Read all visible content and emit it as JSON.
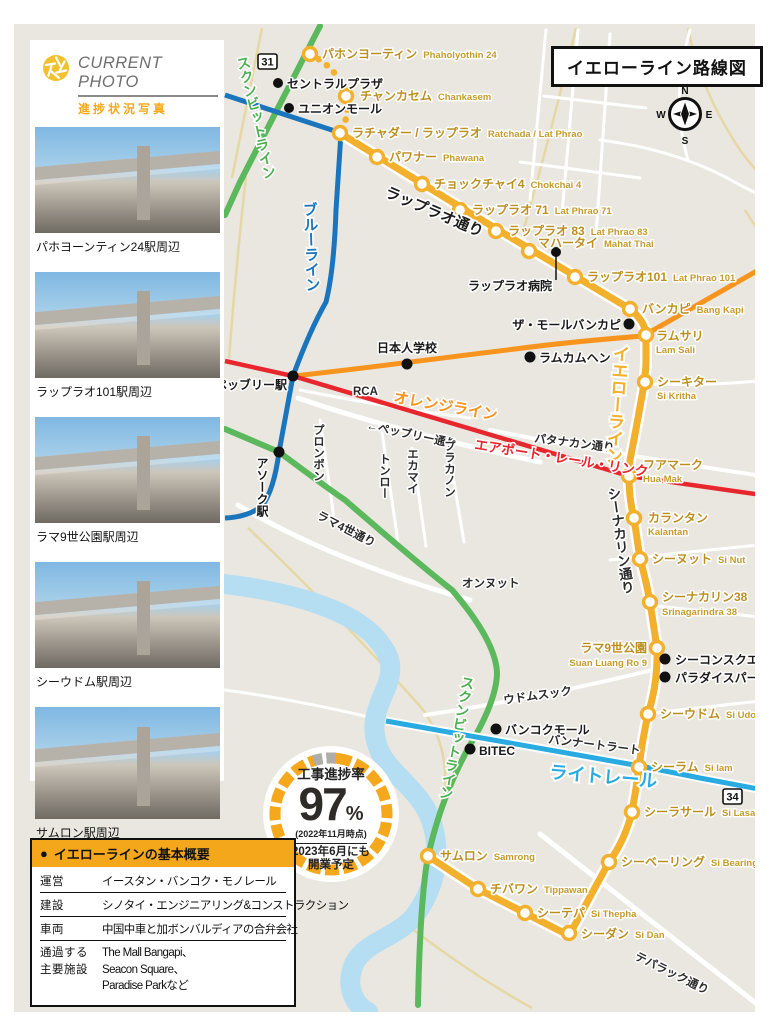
{
  "page": {
    "title_box": "イエローライン路線図"
  },
  "colors": {
    "yellow_line": "#F3B02C",
    "green_line": "#5CB85C",
    "blue_line": "#1B75BC",
    "orange_line": "#F7941E",
    "red_line": "#E8262D",
    "light_rail": "#29ABE2",
    "river": "#B5DEF2",
    "map_bg": "#EAE7E1",
    "accent_orange": "#F5A71B",
    "station_text": "#BC8F1E"
  },
  "compass": {
    "n": "N",
    "e": "E",
    "s": "S",
    "w": "W"
  },
  "shields": {
    "r31": "31",
    "r34": "34"
  },
  "lines": {
    "yellow": "イエローライン",
    "green": "スクンビットライン",
    "blue": "ブルーライン",
    "orange": "オレンジライン",
    "red": "エアポート・レール・リンク",
    "lightblue": "ライトレール"
  },
  "stations": [
    {
      "jp": "パホンヨーティン",
      "en": "Phaholyothin 24"
    },
    {
      "jp": "チャンカセム",
      "en": "Chankasem"
    },
    {
      "jp": "ラチャダー / ラップラオ",
      "en": "Ratchada / Lat Phrao"
    },
    {
      "jp": "パワナー",
      "en": "Phawana"
    },
    {
      "jp": "チョックチャイ4",
      "en": "Chokchai 4"
    },
    {
      "jp": "ラップラオ 71",
      "en": "Lat Phrao 71"
    },
    {
      "jp": "ラップラオ 83",
      "en": "Lat Phrao 83"
    },
    {
      "jp": "マハータイ",
      "en": "Mahat Thai"
    },
    {
      "jp": "ラップラオ101",
      "en": "Lat Phrao 101"
    },
    {
      "jp": "バンカピ",
      "en": "Bang Kapi"
    },
    {
      "jp": "ラムサリ",
      "en": "Lam Sali"
    },
    {
      "jp": "シーキター",
      "en": "Si Kritha"
    },
    {
      "jp": "フアマーク",
      "en": "Hua Mak"
    },
    {
      "jp": "カランタン",
      "en": "Kalantan"
    },
    {
      "jp": "シーヌット",
      "en": "Si Nut"
    },
    {
      "jp": "シーナカリン38",
      "en": "Srinagarindra 38"
    },
    {
      "jp": "ラマ9世公園",
      "en": "Suan Luang Ro 9"
    },
    {
      "jp": "シーウドム",
      "en": "Si Udom"
    },
    {
      "jp": "シーラム",
      "en": "Si Iam"
    },
    {
      "jp": "シーラサール",
      "en": "Si Lasalle"
    },
    {
      "jp": "シーベーリング",
      "en": "Si Bearing"
    },
    {
      "jp": "シーダン",
      "en": "Si Dan"
    },
    {
      "jp": "シーテパ",
      "en": "Si Thepha"
    },
    {
      "jp": "チバワン",
      "en": "Tippawan"
    },
    {
      "jp": "サムロン",
      "en": "Samrong"
    }
  ],
  "pois": {
    "centralplaza": "セントラルプラザ",
    "unionmall": "ユニオンモール",
    "hospital": "ラップラオ病院",
    "mallbangkapi": "ザ・モールバンカピ",
    "ramkhamhaeng": "ラムカムヘン",
    "school": "日本人学校",
    "phetchaburi_sta": "ペッブリー駅",
    "asok_sta": "アソーク駅",
    "seacon": "シーコンスクエア",
    "paradise": "パラダイスパーク",
    "bangkokmall": "バンコクモール",
    "bitec": "BITEC"
  },
  "roads": {
    "latphrao": "ラップラオ通り",
    "phetchaburi": "←ペッブリー通り",
    "rca": "RCA",
    "phromphong": "プロンポン",
    "thonglor": "トンロー",
    "ekamai": "エカマイ",
    "phrakanong": "プラカノン",
    "rama4": "ラマ4世通り",
    "pattanakan": "パタナカン通り",
    "srinagarindra": "シーナカリン通り",
    "onnut": "オンヌット",
    "udomsuk": "ウドムスック",
    "bangna": "バンナートラート",
    "theparak": "テパラック通り"
  },
  "sidebar": {
    "header_en": "CURRENT PHOTO",
    "header_jp": "進捗状況写真",
    "captions": [
      "パホヨーンティン24駅周辺",
      "ラップラオ101駅周辺",
      "ラマ9世公園駅周辺",
      "シーウドム駅周辺",
      "サムロン駅周辺"
    ]
  },
  "progress": {
    "title": "工事進捗率",
    "value": "97",
    "unit": "%",
    "asof": "(2022年11月時点)",
    "note1": "2023年6月にも",
    "note2": "開業予定"
  },
  "infobox": {
    "bullet": "●",
    "title": "イエローラインの基本概要",
    "rows": [
      {
        "label": "運営",
        "value": "イースタン・バンコク・モノレール"
      },
      {
        "label": "建設",
        "value": "シノタイ・エンジニアリング&コンストラクション"
      },
      {
        "label": "車両",
        "value": "中国中車と加ボンバルディアの合弁会社"
      },
      {
        "label1": "通過する",
        "label2": "主要施設",
        "v1": "The Mall Bangapi、",
        "v2": "Seacon Square、",
        "v3": "Paradise Parkなど"
      }
    ]
  }
}
